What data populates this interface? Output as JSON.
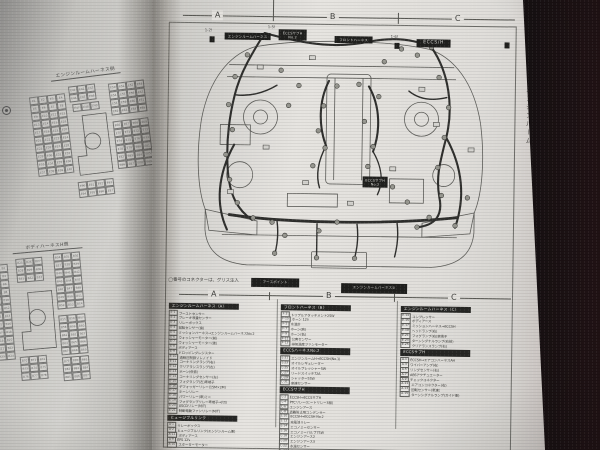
{
  "page": {
    "section_label": "2-1-1",
    "margin_title": "エンジンルーム",
    "column_markers": [
      "A",
      "B",
      "C"
    ],
    "note": "◯番号のコネクターは、グリス注入",
    "note_boxes": [
      "アースポイント",
      "エンジンルームハーネス②"
    ]
  },
  "diagram": {
    "labels": [
      "エンジンルームハーネス",
      "ECCSサブH\nNo.2",
      "フロントハーネス",
      "ECCS/H",
      "ECCSサブH\nNo.2"
    ],
    "callouts": [
      "1-2!",
      "1-5!",
      "1-6!"
    ]
  },
  "left_page": {
    "grids": [
      {
        "title": "エンジンルームハーネス側",
        "prefix": "E",
        "cell": {
          "w": 9,
          "h": 8
        },
        "clusters": [
          {
            "x": 0,
            "y": 10,
            "cols": 4,
            "rows": 10
          },
          {
            "x": 40,
            "y": 4,
            "cols": 3,
            "rows": 2
          },
          {
            "x": 42,
            "y": 22,
            "cols": 3,
            "rows": 1
          },
          {
            "x": 80,
            "y": 6,
            "cols": 4,
            "rows": 4
          },
          {
            "x": 80,
            "y": 44,
            "cols": 4,
            "rows": 6
          },
          {
            "x": 38,
            "y": 100,
            "cols": 4,
            "rows": 2
          }
        ],
        "engine": {
          "x": 41,
          "y": 34,
          "w": 34,
          "h": 60
        }
      },
      {
        "title": "ボディハーネスH側",
        "prefix": "B",
        "cell": {
          "w": 9,
          "h": 8
        },
        "clusters": [
          {
            "x": 0,
            "y": 6,
            "cols": 2,
            "rows": 12
          },
          {
            "x": 26,
            "y": 2,
            "cols": 3,
            "rows": 3
          },
          {
            "x": 64,
            "y": 0,
            "cols": 3,
            "rows": 7
          },
          {
            "x": 64,
            "y": 62,
            "cols": 3,
            "rows": 5
          },
          {
            "x": 22,
            "y": 100,
            "cols": 3,
            "rows": 3
          },
          {
            "x": 64,
            "y": 104,
            "cols": 3,
            "rows": 3
          }
        ],
        "engine": {
          "x": 26,
          "y": 36,
          "w": 34,
          "h": 58
        }
      }
    ]
  },
  "tables": {
    "columns": [
      {
        "marker": "A",
        "sections": [
          {
            "header": "エンジンルームハーネス〈A〉",
            "rows": [
              [
                "E-1",
                "ブーストセンサー"
              ],
              [
                "E-2",
                "ブレーキ液量センサー"
              ],
              [
                "E-3",
                "リレーボックス"
              ],
              [
                "E-4",
                "回転センサー(歯)"
              ],
              [
                "E-5",
                "ミッションハーネス→エンジンルームハーネスNo.2"
              ],
              [
                "E-6",
                "ウォッシャーモーター(前)"
              ],
              [
                "E-7",
                "ウォッシャーモーター(後)"
              ],
              [
                "E-8",
                "ボディアース"
              ],
              [
                "E-9",
                "ドロッピングレジスター"
              ],
              [
                "E-10",
                "過給圧制御ソレノイド"
              ],
              [
                "E-11",
                "コーナリングランプ(右)"
              ],
              [
                "E-12",
                "クリアランスランプ(左)"
              ],
              [
                "E-13",
                "ホーン(低音)"
              ],
              [
                "E-14",
                "コーナリングセンサー(左)"
              ],
              [
                "E-15",
                "フォグランプ(左)車端子"
              ],
              [
                "E-16",
                "デフォッガーリレー(15M×2M)"
              ],
              [
                "E-17",
                "ホーンリレー"
              ],
              [
                "E-18",
                "パワーリレー(車)ミニ"
              ],
              [
                "E-19",
                "フォグランプリレー車端子→(切)"
              ],
              [
                "E-20",
                "ASCDリレー(M/T)"
              ],
              [
                "E-21",
                "制動電動ファンリレー(M/T)"
              ]
            ]
          },
          {
            "header": "ヒュージブルリンク",
            "rows": [
              [
                "A-1",
                "リレーボックス"
              ],
              [
                "A-2",
                "ヒュージブルリンク(エンジンルーム側)"
              ],
              [
                "A-11",
                "ボディアース"
              ],
              [
                "A-9",
                "EPS 12V"
              ],
              [
                "A-10",
                "スターターモーター"
              ]
            ]
          }
        ]
      },
      {
        "marker": "B",
        "sections": [
          {
            "header": "フロントハーネス〈B〉",
            "rows": [
              [
                "F-3",
                "トリプルアタッチメント25W"
              ],
              [
                "F-15",
                "ホーン 12V"
              ],
              [
                "F-1",
                "水温計"
              ],
              [
                "F-7",
                "ホーン(高)"
              ],
              [
                "F-9",
                "ホーン(低)"
              ],
              [
                "F-11",
                "公害センサー"
              ],
              [
                "F-13",
                "排気温度ファンモーター"
              ]
            ]
          },
          {
            "header": "ECCSハーネスNo.2",
            "rows": [
              [
                "L-21",
                "エンジンルームH→ECCSH(No.1)"
              ],
              [
                "L-23",
                "オイルレギュレーター"
              ],
              [
                "L-25",
                "オイルプレッシャー5W"
              ],
              [
                "L-27",
                "リードスイッチ72A"
              ],
              [
                "L-29",
                "シャッター55W"
              ],
              [
                "L-31",
                "車速センサー"
              ]
            ]
          },
          {
            "header": "ECCSサブH",
            "rows": [
              [
                "L-2",
                "ECCSH→ECCSサブH"
              ],
              [
                "L-4",
                "PTCリレー(ヒートリレー3極)"
              ],
              [
                "L-6",
                "エンジンアース"
              ],
              [
                "L-8",
                "盗難防止用コンデンサー"
              ],
              [
                "L-10",
                "ECCSH→ECCSH No.2"
              ],
              [
                "L-12",
                "充電池リレー"
              ],
              [
                "L-14",
                "エコノミーセンサー"
              ],
              [
                "L-16",
                "エコノミーバルブ75W"
              ],
              [
                "L-18",
                "エンジンアース2"
              ],
              [
                "L-20",
                "エンジンアース3"
              ],
              [
                "L-22",
                "水温センサー"
              ],
              [
                "L-24",
                "サーマルトランスミッター"
              ]
            ]
          }
        ]
      },
      {
        "marker": "C",
        "sections": [
          {
            "header": "エンジンルームハーネス〈C〉",
            "rows": [
              [
                "E-14",
                "コンプレッサー"
              ],
              [
                "E-15",
                "ボディアース"
              ],
              [
                "E-17",
                "ミッションハーネス→ECCSH"
              ],
              [
                "E-19",
                "ヘッドランプ(右)"
              ],
              [
                "E-21",
                "フォグランプ(右)車端子"
              ],
              [
                "E-23",
                "ターンシグナルランプ(右前)"
              ],
              [
                "E-25",
                "クリアランスランプ(右)"
              ]
            ]
          },
          {
            "header": "ECCSサブH",
            "rows": [
              [
                "A-1",
                "ECCSH→エアコンハーネスAH"
              ],
              [
                "A-3",
                "ワイパーアンプ(右)"
              ],
              [
                "A-5",
                "リングセンサー(右)"
              ],
              [
                "A-7",
                "ABSアクチュエーター"
              ],
              [
                "A-9",
                "チェックコネクター"
              ],
              [
                "A-11",
                "エアコンコネクター(右)"
              ],
              [
                "A-13",
                "回転センサー(車速)"
              ],
              [
                "A-15",
                "ターンシグナルランプ(ガイド側)"
              ]
            ]
          }
        ]
      }
    ]
  },
  "colors": {
    "paper": "#e9e7e3",
    "ink": "#3b3b38",
    "label_bg": "#1d1d1b",
    "background": "#131011"
  }
}
